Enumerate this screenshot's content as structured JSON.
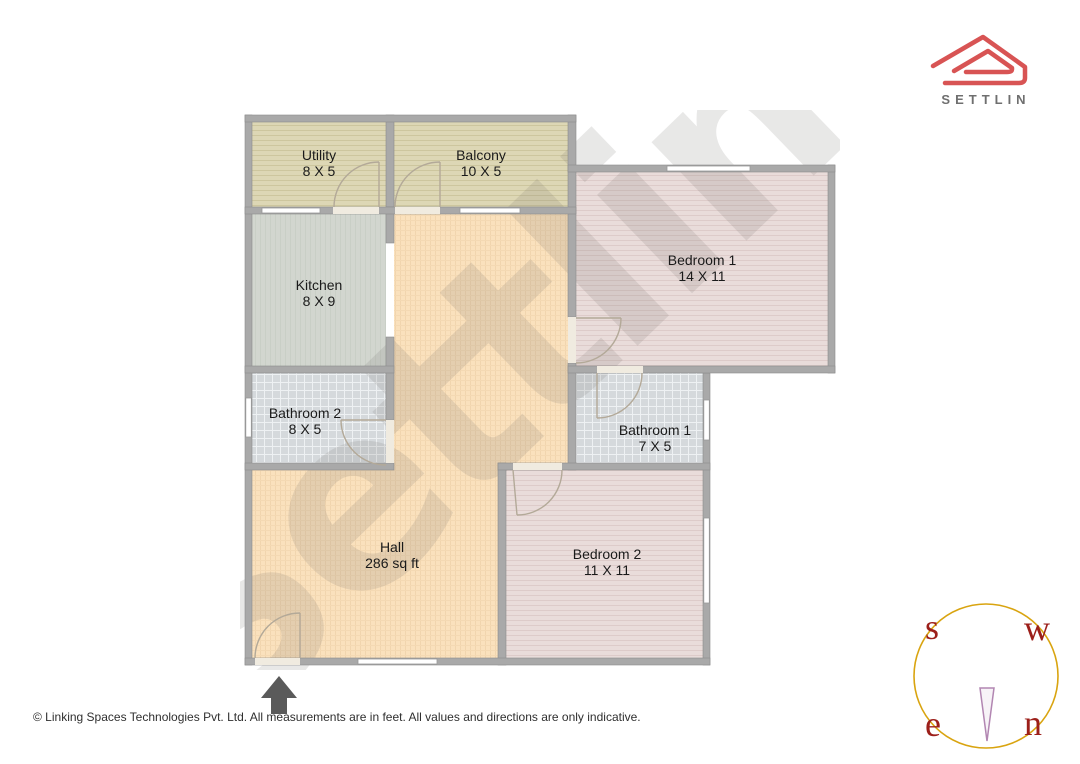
{
  "brand": {
    "logo_text": "SETTLIN",
    "logo_color": "#d85454",
    "logo_text_color": "#6f6f6f"
  },
  "watermark": {
    "text": "Settlin"
  },
  "rooms": [
    {
      "name": "Utility",
      "dims": "8 X 5"
    },
    {
      "name": "Balcony",
      "dims": "10 X 5"
    },
    {
      "name": "Kitchen",
      "dims": "8 X 9"
    },
    {
      "name": "Bedroom 1",
      "dims": "14 X 11"
    },
    {
      "name": "Bathroom 2",
      "dims": "8 X 5"
    },
    {
      "name": "Bathroom 1",
      "dims": "7 X 5"
    },
    {
      "name": "Hall",
      "dims": "286 sq ft"
    },
    {
      "name": "Bedroom 2",
      "dims": "11 X 11"
    }
  ],
  "compass": {
    "top_left": "s",
    "top_right": "w",
    "bottom_left": "e",
    "bottom_right": "n",
    "circle_color": "#d9a410",
    "letter_color": "#9c1f1a",
    "needle_color": "#b286b2"
  },
  "footer": {
    "text": "© Linking Spaces Technologies Pvt. Ltd. All measurements are in feet. All values and directions are only indicative."
  },
  "palette": {
    "wall": "#a9a9a9",
    "deck_floor": "#ddd7b5",
    "kitchen_floor": "#d2d6cf",
    "hall_floor": "#fae1bd",
    "bedroom_floor": "#e9dcda",
    "bathroom_floor": "#d5d9dc",
    "door_arc": "#b3a998"
  }
}
